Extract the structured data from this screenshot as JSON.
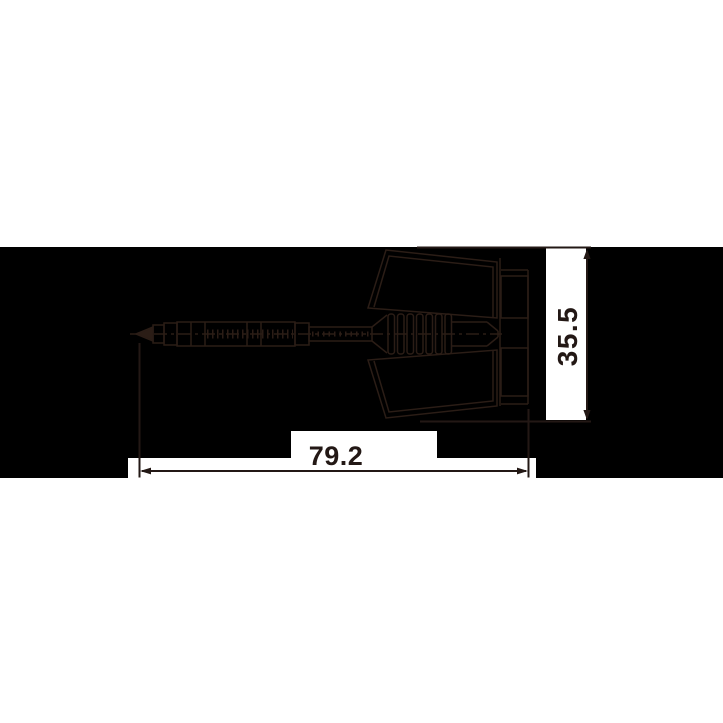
{
  "page": {
    "background": "#ffffff"
  },
  "band": {
    "top": 247,
    "height": 231,
    "color": "#000000"
  },
  "artwork": {
    "subject": "dart-side-view-technical-line-drawing",
    "line_color": "#2b1d16",
    "annotation_color": "#231815",
    "label_patch_color": "#ffffff"
  },
  "dimensions": {
    "horizontal": {
      "label": "79.2"
    },
    "vertical": {
      "label": "35.5"
    }
  }
}
